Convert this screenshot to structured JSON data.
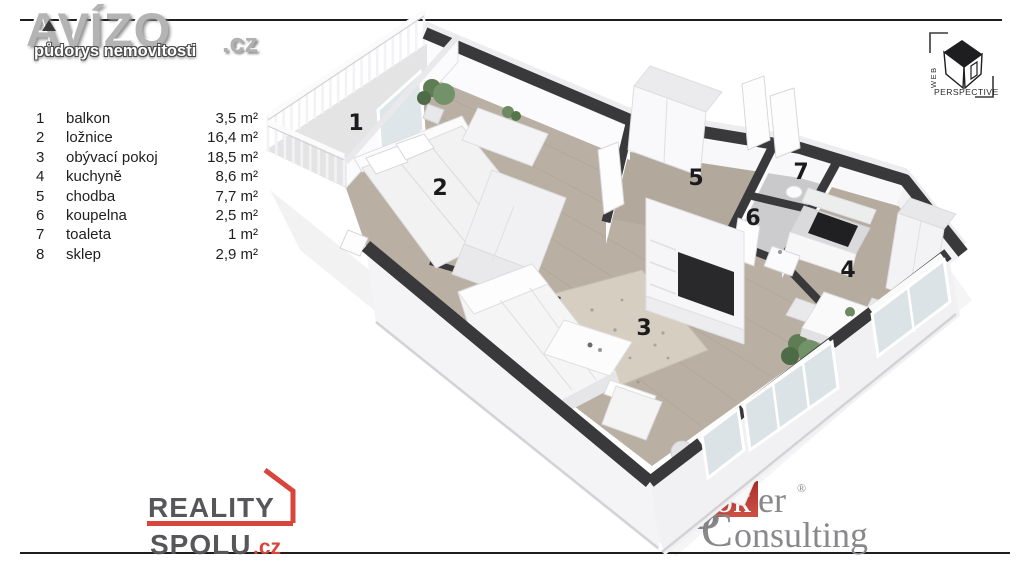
{
  "branding": {
    "avizo": {
      "name": "AVÍZO",
      "tld": ".cz",
      "tagline": "půdorys nemovitosti"
    },
    "web_perspective": {
      "word1": "WEB",
      "word2": "PERSPECTIVE"
    },
    "reality_spolu": {
      "word1": "REALITY",
      "word2": "SPOLU",
      "tld": ".cz"
    },
    "broker_consulting": {
      "initial_b": "B",
      "ok": "ok",
      "er": "er",
      "registered": "®",
      "initial_c": "C",
      "rest": "onsulting"
    }
  },
  "legend": {
    "rows": [
      {
        "num": "1",
        "name": "balkon",
        "area": "3,5 m²"
      },
      {
        "num": "2",
        "name": "ložnice",
        "area": "16,4 m²"
      },
      {
        "num": "3",
        "name": "obývací pokoj",
        "area": "18,5 m²"
      },
      {
        "num": "4",
        "name": "kuchyně",
        "area": "8,6 m²"
      },
      {
        "num": "5",
        "name": "chodba",
        "area": "7,7 m²"
      },
      {
        "num": "6",
        "name": "koupelna",
        "area": "2,5 m²"
      },
      {
        "num": "7",
        "name": "toaleta",
        "area": "1 m²"
      },
      {
        "num": "8",
        "name": "sklep",
        "area": "2,9 m²"
      }
    ]
  },
  "floor_plan": {
    "room_labels": [
      {
        "num": "1",
        "x": 356,
        "y": 130
      },
      {
        "num": "2",
        "x": 440,
        "y": 195
      },
      {
        "num": "3",
        "x": 644,
        "y": 335
      },
      {
        "num": "4",
        "x": 848,
        "y": 277
      },
      {
        "num": "5",
        "x": 696,
        "y": 185
      },
      {
        "num": "6",
        "x": 753,
        "y": 225
      },
      {
        "num": "7",
        "x": 801,
        "y": 179
      }
    ],
    "palette": {
      "wall_top": "#39393b",
      "wall_face": "#f4f4f6",
      "floor_wood": "#b9b0a3",
      "floor_tile": "#c9c9cb",
      "balcony_floor": "#e4e4e5",
      "glass": "#dce3e6",
      "rug": "#d3ccbf",
      "accent_red": "#d8453a",
      "logo_gray": "#89898c"
    }
  }
}
